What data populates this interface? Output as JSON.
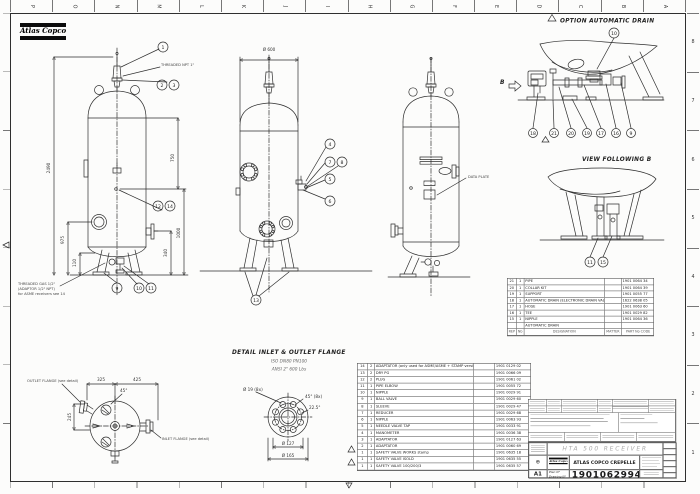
{
  "frame": {
    "top_letters": [
      "P",
      "O",
      "N",
      "M",
      "L",
      "K",
      "J",
      "I",
      "H",
      "G",
      "F",
      "E",
      "D",
      "C",
      "B",
      "A"
    ],
    "right_numbers": [
      "8",
      "7",
      "6",
      "5",
      "4",
      "3",
      "2",
      "1"
    ]
  },
  "logo": {
    "brand": "Atlas Copco"
  },
  "icons": {
    "warning": "△",
    "projection": "⊕"
  },
  "titles": {
    "option_drain": "OPTION AUTOMATIC DRAIN",
    "view_b": "VIEW FOLLOWING B",
    "detail_flange": "DETAIL INLET & OUTLET FLANGE",
    "flange_iso": "ISO DN80 PN100",
    "flange_ansi": "ANSI 2\" 600 Lbs"
  },
  "labels": {
    "b_marker": "B",
    "data_plate": "DATA PLATE",
    "hta_sticker": "HTA 500",
    "outlet_flange": "OUTLET FLANGE (see detail)",
    "inlet_flange": "INLET FLANGE (see detail)",
    "threaded_npt": "THREADED NPT 1\"",
    "threaded_gas_l1": "THREADED GAS 1/2\"",
    "threaded_gas_l2": "(ADAPTOR 1/2\" NPT)",
    "threaded_gas_l3": "for ASME receivers see 14"
  },
  "dims": {
    "dia600": "Ø 600",
    "h2490": "2490",
    "h975": "975",
    "h750": "750",
    "h1000": "1000",
    "h340": "340",
    "h110": "110",
    "w325": "325",
    "w425": "425",
    "a45": "45°",
    "h245": "245",
    "hole": "Ø 19 (8x)",
    "a45x8": "45° (8x)",
    "a225": "22.5°",
    "d127": "Ø 127",
    "d165": "Ø 165"
  },
  "balloons": {
    "n1": "1",
    "n2": "2",
    "n3": "3",
    "n4": "4",
    "n5": "5",
    "n6": "6",
    "n7": "7",
    "n8": "8",
    "n9": "9",
    "n10": "10",
    "n11": "11",
    "n12": "12",
    "n13": "13",
    "n14": "14",
    "n15": "15",
    "n16": "16",
    "n17": "17",
    "n18": "18",
    "n19": "19",
    "n20": "20",
    "n21": "21"
  },
  "parts_table": {
    "rows": [
      {
        "rep": "14",
        "nb": "2",
        "des": "ADAPTATOR (only used for ASME/ASME + STAMP versions)",
        "mat": "",
        "part": "1901 0129 02"
      },
      {
        "rep": "13",
        "nb": "2",
        "des": "DRY PG",
        "mat": "",
        "part": "1901 0066 09"
      },
      {
        "rep": "12",
        "nb": "2",
        "des": "PLUG",
        "mat": "",
        "part": "1901 0061 02"
      },
      {
        "rep": "11",
        "nb": "1",
        "des": "PIPE ELBOW",
        "mat": "",
        "part": "1901 0055 72"
      },
      {
        "rep": "10",
        "nb": "1",
        "des": "NIPPLE",
        "mat": "",
        "part": "1901 0029 91"
      },
      {
        "rep": "9",
        "nb": "1",
        "des": "BALL VALVE",
        "mat": "",
        "part": "1901 0029 60"
      },
      {
        "rep": "8",
        "nb": "1",
        "des": "SLEEVE",
        "mat": "",
        "part": "1901 0029 47"
      },
      {
        "rep": "7",
        "nb": "1",
        "des": "REDUCER",
        "mat": "",
        "part": "1901 0029 68"
      },
      {
        "rep": "6",
        "nb": "1",
        "des": "NIPPLE",
        "mat": "",
        "part": "1901 0063 93"
      },
      {
        "rep": "5",
        "nb": "1",
        "des": "NEEDLE VALVE TAP",
        "mat": "",
        "part": "1901 0033 91"
      },
      {
        "rep": "4",
        "nb": "1",
        "des": "MANOMETER",
        "mat": "",
        "part": "1901 0036 38"
      },
      {
        "rep": "3",
        "nb": "1",
        "des": "ADAPTATOR",
        "mat": "",
        "part": "1901 0127 63"
      },
      {
        "rep": "2",
        "nb": "1",
        "des": "ADAPTATOR",
        "mat": "",
        "part": "1901 0060 69"
      },
      {
        "rep": "1",
        "nb": "1",
        "des": "SAFETY VALVE WORKS stamp",
        "mat": "",
        "part": "1901 0635 18"
      },
      {
        "rep": "1",
        "nb": "1",
        "des": "SAFETY VALVE ISOLD",
        "mat": "",
        "part": "1901 0635 55"
      },
      {
        "rep": "1",
        "nb": "1",
        "des": "SAFETY VALVE 100/200/3",
        "mat": "",
        "part": "1901 0635 57"
      }
    ]
  },
  "drain_table": {
    "rows": [
      {
        "rep": "21",
        "nb": "1",
        "des": "PIPE",
        "mat": "",
        "part": "1901 0064 34"
      },
      {
        "rep": "20",
        "nb": "1",
        "des": "COLLAR KIT",
        "mat": "",
        "part": "1901 0064 39"
      },
      {
        "rep": "19",
        "nb": "1",
        "des": "SUPPORT",
        "mat": "",
        "part": "1901 0055 77"
      },
      {
        "rep": "18",
        "nb": "1",
        "des": "AUTOMATIC DRAIN (ELECTRONIC DRAIN VALVE) + COMP",
        "mat": "",
        "part": "1622 0638 05"
      },
      {
        "rep": "17",
        "nb": "1",
        "des": "HOSE",
        "mat": "",
        "part": "1901 0063 60"
      },
      {
        "rep": "16",
        "nb": "1",
        "des": "TEE",
        "mat": "",
        "part": "1901 0029 82"
      },
      {
        "rep": "15",
        "nb": "1",
        "des": "NIPPLE",
        "mat": "",
        "part": "1901 0064 36"
      }
    ],
    "group_label": "AUTOMATIC DRAIN",
    "headers": {
      "rep": "REP",
      "nb": "Nb",
      "designation": "DESIGNATION",
      "matter": "MATTER",
      "part": "PART No CODE"
    }
  },
  "title_block": {
    "product": "HTA 500 RECEIVER",
    "company": "ATLAS COPCO CREPELLE",
    "plan_label": "Plan N°",
    "drawing_label": "Drawing N°",
    "number": "1901062994",
    "format": "A1"
  }
}
